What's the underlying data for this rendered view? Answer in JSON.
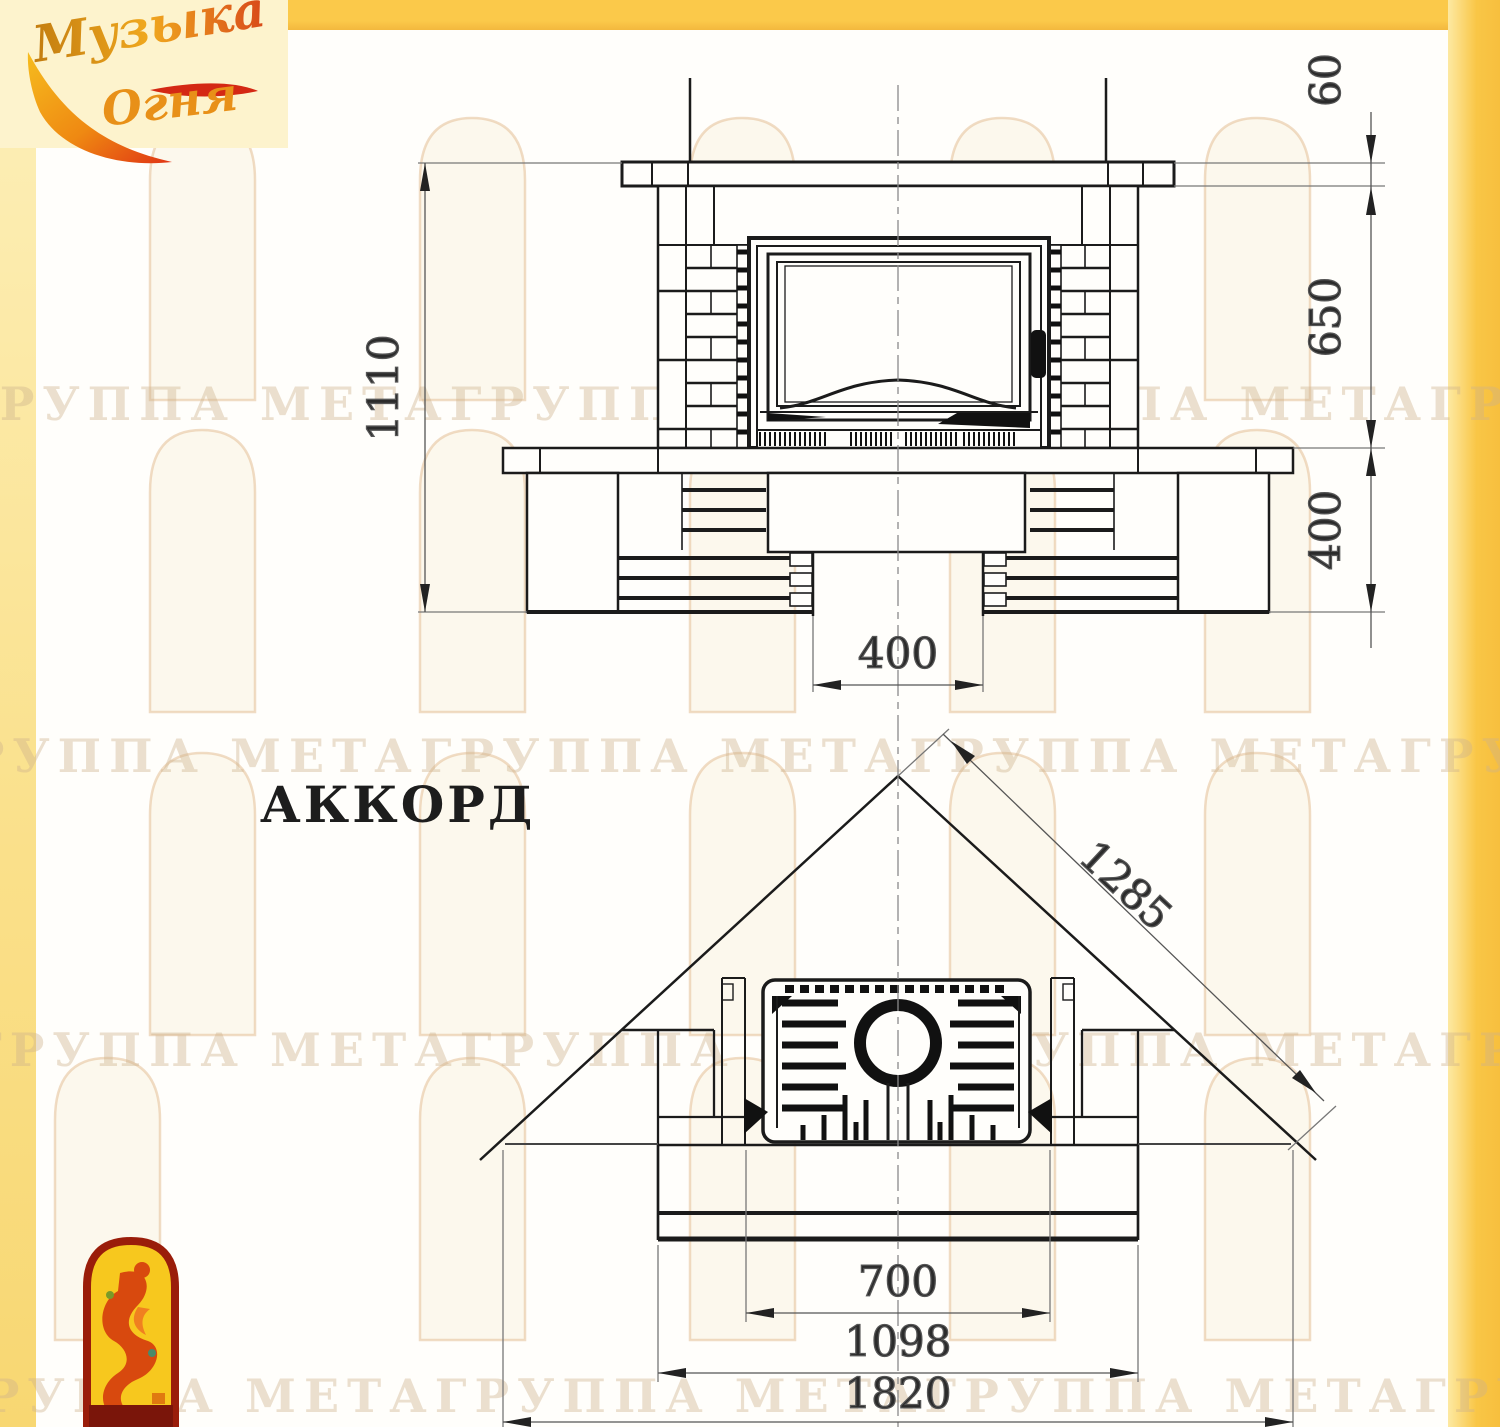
{
  "page": {
    "product_name": "АККОРД"
  },
  "logo": {
    "word1": "Музыка",
    "word2": "Огня"
  },
  "watermark": {
    "row_text": "ГРУППА МЕТАГРУППА МЕТАГРУППА МЕТАГРУППА МЕТА"
  },
  "front_view": {
    "dim_total_height": "1110",
    "dim_mantel_thickness": "60",
    "dim_firebox_band": "650",
    "dim_base_band": "400",
    "dim_niche_width": "400"
  },
  "plan_view": {
    "dim_diagonal": "1285",
    "dim_firebox_opening": "700",
    "dim_hearth_width": "1098",
    "dim_overall_width": "1820"
  },
  "colors": {
    "accent_yellow": "#f9c646",
    "panel_cream": "#fdf3cd",
    "emblem_red": "#9a1d0a",
    "emblem_yellow": "#f7c81e",
    "line_dark": "#1b1b1b"
  }
}
